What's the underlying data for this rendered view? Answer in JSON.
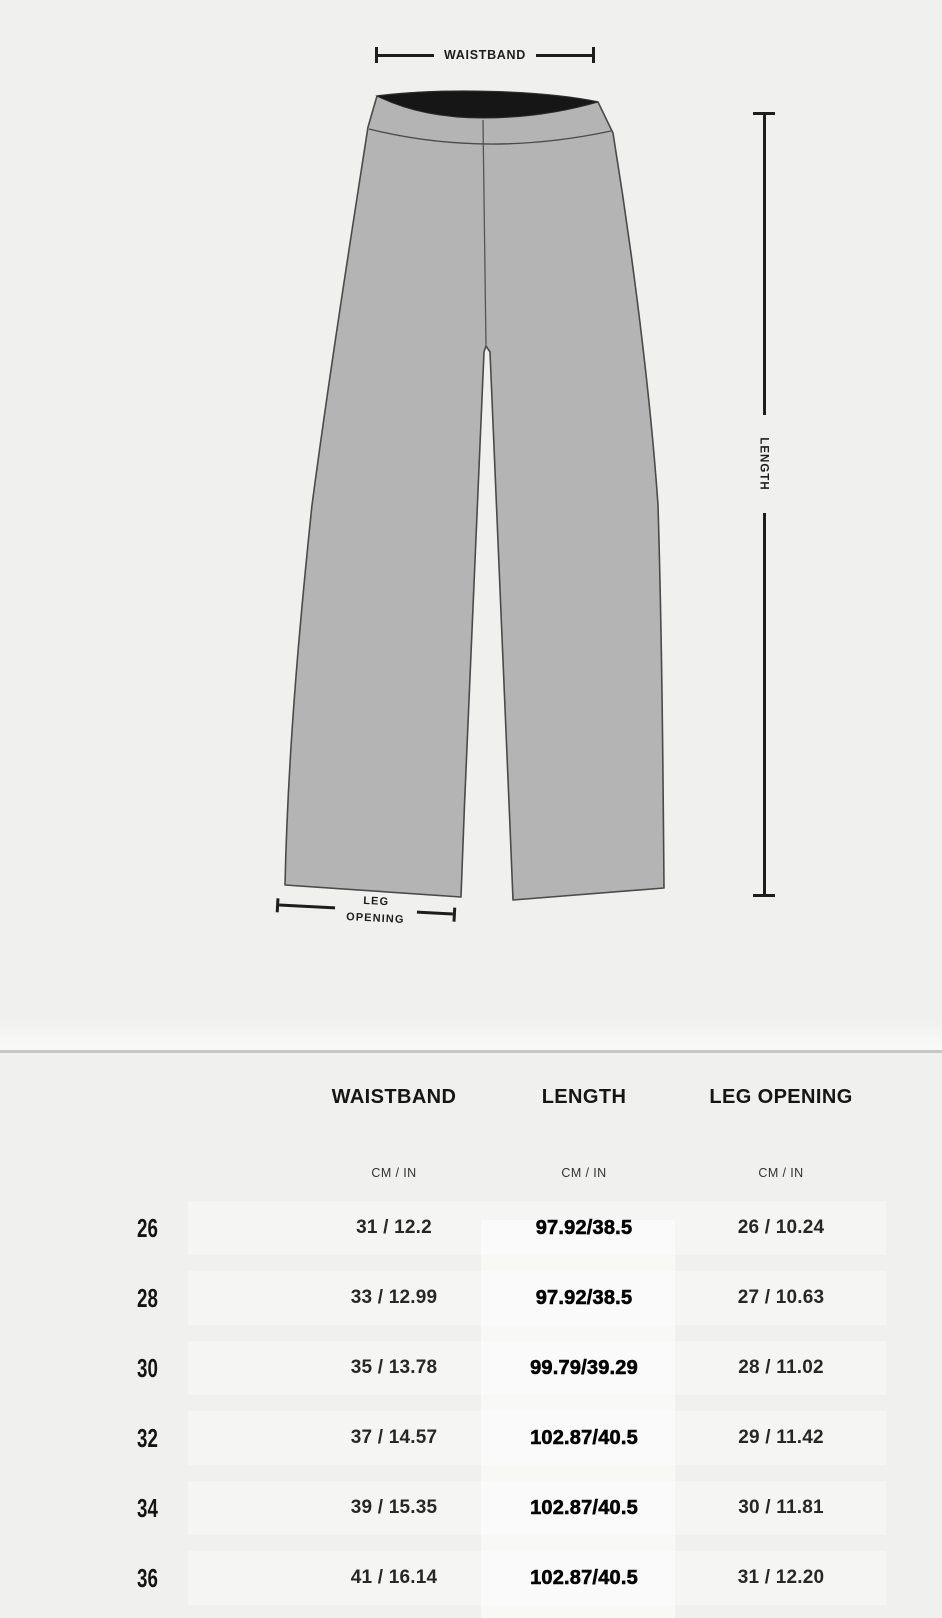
{
  "diagram": {
    "waistband_label": "WAISTBAND",
    "length_label": "LENGTH",
    "leg_opening_label_line1": "LEG",
    "leg_opening_label_line2": "OPENING"
  },
  "table": {
    "columns": [
      {
        "label": "WAISTBAND",
        "unit": "CM / IN"
      },
      {
        "label": "LENGTH",
        "unit": "CM / IN"
      },
      {
        "label": "LEG OPENING",
        "unit": "CM / IN"
      }
    ],
    "rows": [
      {
        "size": "26",
        "waistband": "31 / 12.2",
        "length": "97.92/38.5",
        "leg_opening": "26 / 10.24"
      },
      {
        "size": "28",
        "waistband": "33 / 12.99",
        "length": "97.92/38.5",
        "leg_opening": "27 / 10.63"
      },
      {
        "size": "30",
        "waistband": "35 / 13.78",
        "length": "99.79/39.29",
        "leg_opening": "28 / 11.02"
      },
      {
        "size": "32",
        "waistband": "37 / 14.57",
        "length": "102.87/40.5",
        "leg_opening": "29 / 11.42"
      },
      {
        "size": "34",
        "waistband": "39 / 15.35",
        "length": "102.87/40.5",
        "leg_opening": "30 / 11.81"
      },
      {
        "size": "36",
        "waistband": "41 / 16.14",
        "length": "102.87/40.5",
        "leg_opening": "31 / 12.20"
      }
    ]
  },
  "colors": {
    "page_background": "#f0f0ee",
    "pants_fill": "#b4b4b4",
    "pants_outline": "#4a4a4a",
    "waistband_inner": "#161616",
    "dimension_lines": "#1d1d1d",
    "divider": "#c6c6c6",
    "length_column_highlight": "#f8f8f6"
  }
}
